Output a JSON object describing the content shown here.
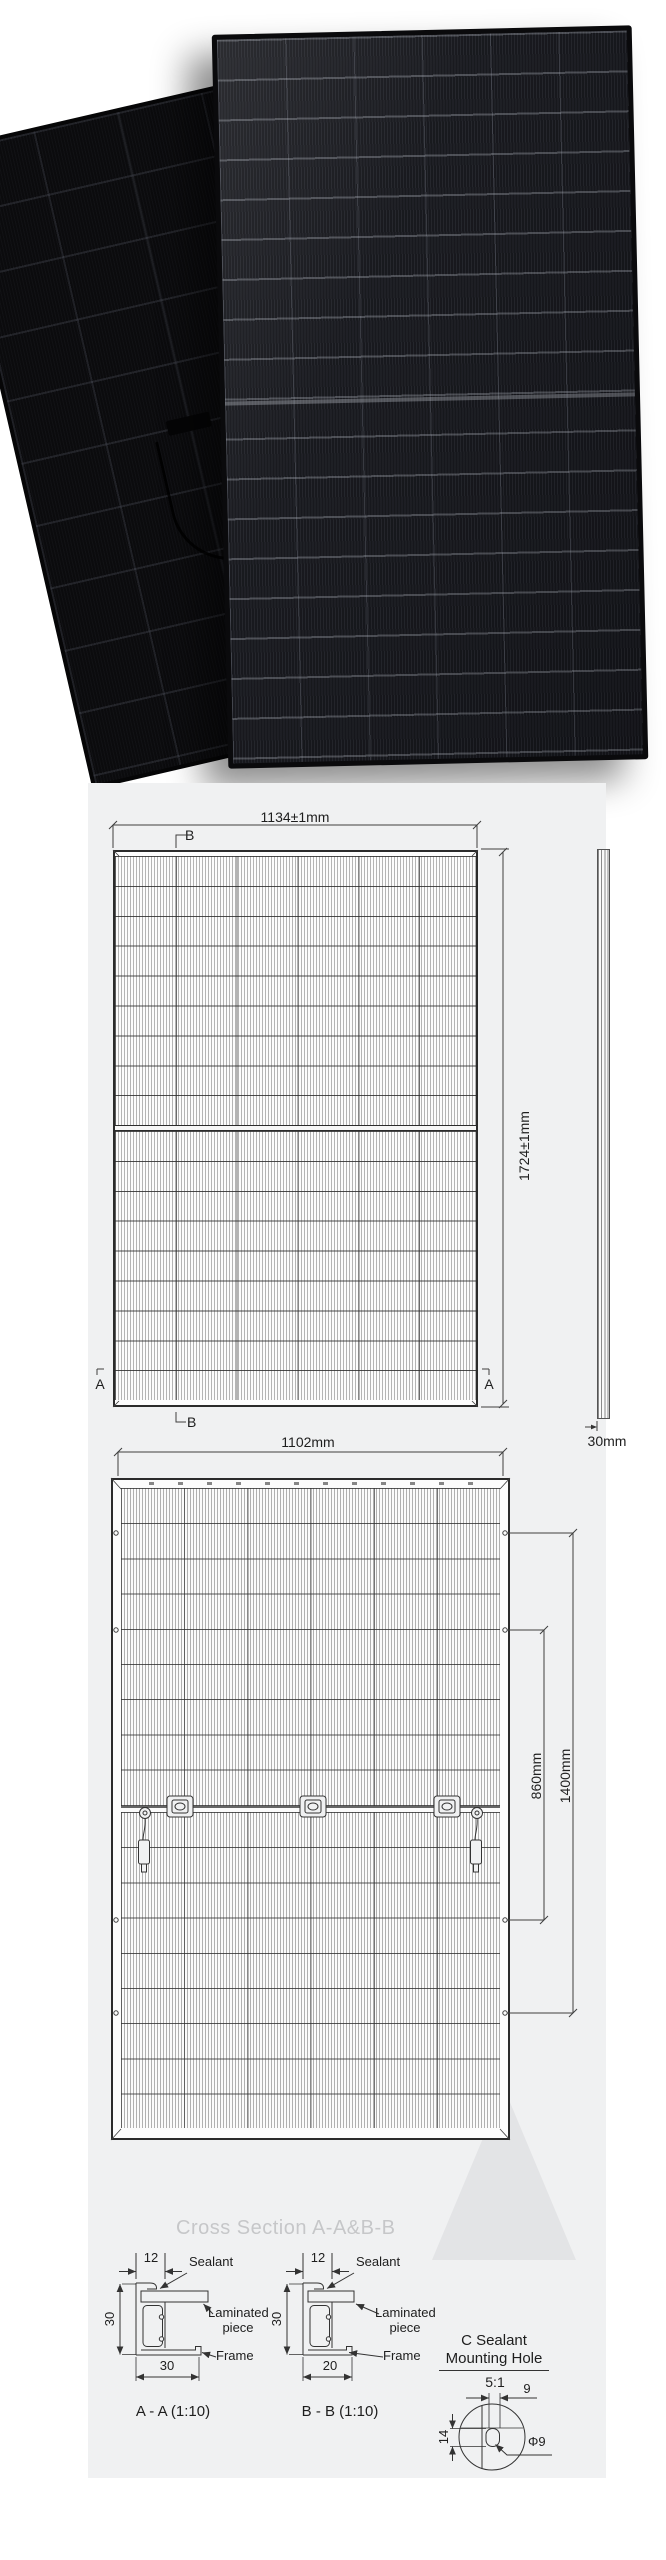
{
  "front_view": {
    "width": "1134±1mm",
    "height": "1724±1mm",
    "thickness": "30mm",
    "marker_a": "A",
    "marker_b": "B"
  },
  "back_view": {
    "width": "1102mm",
    "inner_span": "860mm",
    "outer_span": "1400mm"
  },
  "cross_sections": {
    "title": "Cross Section A-A&B-B",
    "aa": {
      "top_width": "12",
      "height": "30",
      "bottom_width": "30",
      "sealant": "Sealant",
      "laminated_line1": "Laminated",
      "laminated_line2": "piece",
      "frame": "Frame",
      "caption": "A - A (1:10)"
    },
    "bb": {
      "top_width": "12",
      "height": "30",
      "bottom_width": "20",
      "sealant": "Sealant",
      "laminated_line1": "Laminated",
      "laminated_line2": "piece",
      "frame": "Frame",
      "caption": "B - B (1:10)"
    },
    "mounting_hole": {
      "title_line1": "C Sealant",
      "title_line2": "Mounting Hole",
      "scale": "5:1",
      "width": "9",
      "height": "14",
      "diameter": "Φ9"
    }
  },
  "colors": {
    "sheet_background": "#f0f1f2",
    "line": "#3a3a3a",
    "watermark": "#e3e4e6",
    "title_gray": "#c6c7c9",
    "module_dark": "#14151a"
  }
}
